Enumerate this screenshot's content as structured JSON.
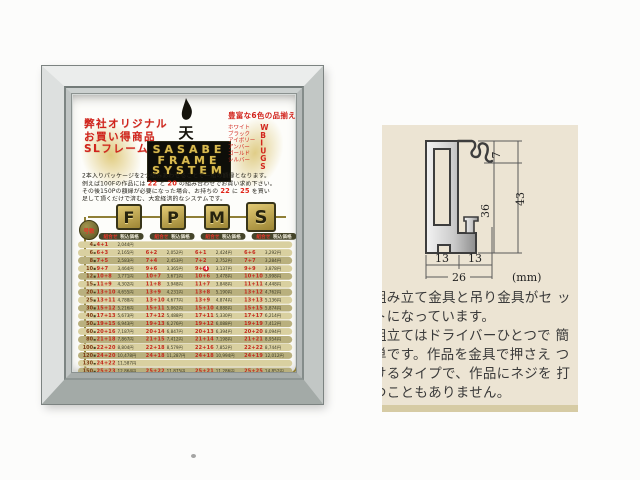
{
  "poster": {
    "promo": {
      "lines": [
        "弊社オリジナル",
        "お買い得商品",
        "SLフレーム"
      ]
    },
    "brand": {
      "mark": "天",
      "lines": [
        "SASABE",
        "FRAME",
        "SYSTEM"
      ]
    },
    "colors": {
      "title": "豊富な6色の品揃え",
      "names": [
        "ホワイト",
        "ブラック",
        "アイボリー",
        "アンバー",
        "ゴールド",
        "シルバー"
      ],
      "codes": [
        "W",
        "B",
        "I",
        "U",
        "G",
        "S"
      ]
    },
    "intro": {
      "lines": [
        [
          {
            "t": "2本入りパッケージを2つ組みあわせることで一組の額縁となります。"
          }
        ],
        [
          {
            "t": "例えば100Fの作品には "
          },
          {
            "t": "22",
            "hl": true
          },
          {
            "t": " と "
          },
          {
            "t": "20",
            "hl": true
          },
          {
            "t": " の組み合わせでお買い求め下さい。"
          }
        ],
        [
          {
            "t": "その後150Pの額縁が必要になった場合、お持ちの "
          },
          {
            "t": "22",
            "hl": true
          },
          {
            "t": " に "
          },
          {
            "t": "25",
            "hl": true
          },
          {
            "t": " を買い"
          }
        ],
        [
          {
            "t": "足して頂くだけで済む、大変経済的なシステムです。"
          }
        ]
      ]
    },
    "system": {
      "letters": [
        "F",
        "P",
        "M",
        "S"
      ],
      "size_badge": "号数",
      "header_left": "組合せ",
      "header_right": "税込価格"
    },
    "table": {
      "rows": [
        {
          "size": "4",
          "cols": [
            [
              "4+1",
              "2,044円"
            ],
            null,
            null,
            null
          ]
        },
        {
          "size": "6",
          "cols": [
            [
              "6+3",
              "2,165円"
            ],
            [
              "6+2",
              "2,052円"
            ],
            [
              "6+1",
              "2,424円"
            ],
            [
              "6+6",
              "3,292円"
            ]
          ]
        },
        {
          "size": "8",
          "cols": [
            [
              "7+5",
              "2,583円"
            ],
            [
              "7+4",
              "2,453円"
            ],
            [
              "7+2",
              "2,752円"
            ],
            [
              "7+7",
              "3,284円"
            ]
          ]
        },
        {
          "size": "10",
          "cols": [
            [
              "9+7",
              "3,464円"
            ],
            [
              "9+6",
              "3,365円"
            ],
            [
              "9+4",
              "3,137円",
              "dot"
            ],
            [
              "9+9",
              "3,878円"
            ]
          ]
        },
        {
          "size": "12",
          "cols": [
            [
              "10+8",
              "3,771円"
            ],
            [
              "10+7",
              "3,671円"
            ],
            [
              "10+6",
              "3,478円"
            ],
            [
              "10+10",
              "3,998円"
            ]
          ]
        },
        {
          "size": "15",
          "cols": [
            [
              "11+9",
              "4,302円"
            ],
            [
              "11+8",
              "3,948円"
            ],
            [
              "11+7",
              "3,848円"
            ],
            [
              "11+11",
              "4,448円"
            ]
          ]
        },
        {
          "size": "20",
          "cols": [
            [
              "13+10",
              "4,655円"
            ],
            [
              "13+9",
              "4,231円"
            ],
            [
              "13+8",
              "5,190円"
            ],
            [
              "13+12",
              "4,762円"
            ]
          ]
        },
        {
          "size": "25",
          "cols": [
            [
              "13+11",
              "4,788円"
            ],
            [
              "13+10",
              "4,677円"
            ],
            [
              "13+9",
              "4,874円"
            ],
            [
              "13+13",
              "5,136円"
            ]
          ]
        },
        {
          "size": "30",
          "cols": [
            [
              "15+12",
              "5,216円"
            ],
            [
              "15+11",
              "5,062円"
            ],
            [
              "15+10",
              "4,888円"
            ],
            [
              "15+15",
              "5,874円"
            ]
          ]
        },
        {
          "size": "40",
          "cols": [
            [
              "17+13",
              "5,673円"
            ],
            [
              "17+12",
              "5,488円"
            ],
            [
              "17+11",
              "5,330円"
            ],
            [
              "17+17",
              "6,214円"
            ]
          ]
        },
        {
          "size": "50",
          "cols": [
            [
              "19+15",
              "6,943円"
            ],
            [
              "19+13",
              "6,276円"
            ],
            [
              "19+12",
              "6,088円"
            ],
            [
              "19+19",
              "7,412円"
            ]
          ]
        },
        {
          "size": "60",
          "cols": [
            [
              "20+16",
              "7,187円"
            ],
            [
              "20+14",
              "6,847円"
            ],
            [
              "20+13",
              "6,394円"
            ],
            [
              "20+20",
              "8,094円"
            ]
          ]
        },
        {
          "size": "80",
          "cols": [
            [
              "21+18",
              "7,867円"
            ],
            [
              "21+15",
              "7,412円"
            ],
            [
              "21+14",
              "7,198円"
            ],
            [
              "21+21",
              "8,954円"
            ]
          ]
        },
        {
          "size": "100",
          "cols": [
            [
              "22+20",
              "8,804円"
            ],
            [
              "22+18",
              "8,579円"
            ],
            [
              "22+16",
              "7,852円"
            ],
            [
              "22+22",
              "8,744円"
            ]
          ]
        },
        {
          "size": "120",
          "cols": [
            [
              "24+20",
              "10,478円"
            ],
            [
              "24+18",
              "11,287円"
            ],
            [
              "24+18",
              "10,994円"
            ],
            [
              "24+19",
              "12,012円"
            ]
          ]
        },
        {
          "size": "130",
          "cols": [
            [
              "24+22",
              "11,587円"
            ],
            null,
            null,
            null
          ]
        },
        {
          "size": "150",
          "cols": [
            [
              "25+23",
              "12,864円"
            ],
            [
              "25+22",
              "11,875円"
            ],
            [
              "25+21",
              "11,286円"
            ],
            [
              "25+25",
              "14,852円"
            ]
          ]
        }
      ]
    }
  },
  "panel": {
    "diagram": {
      "dim_hook": "7",
      "dim_inner": "36",
      "dim_total": "43",
      "dim_left": "13",
      "dim_right": "13",
      "dim_width": "26",
      "unit": "(mm)"
    },
    "description": {
      "lines": [
        "組み立て金具と吊り金具がセ ッ",
        "トになっています。",
        "組立てはドライバーひとつで 簡",
        "単です。作品を金具で押さえ つ",
        "けるタイプで、作品にネジを 打",
        "つこともありません。"
      ]
    }
  },
  "colors": {
    "accent_red": "#d2231c",
    "gold": "#c9b96a",
    "frame_silver": "#c2c7c5",
    "panel_beige": "#ece4d3",
    "row_light": "#d9d0a0",
    "row_dark": "#b9b07e"
  }
}
